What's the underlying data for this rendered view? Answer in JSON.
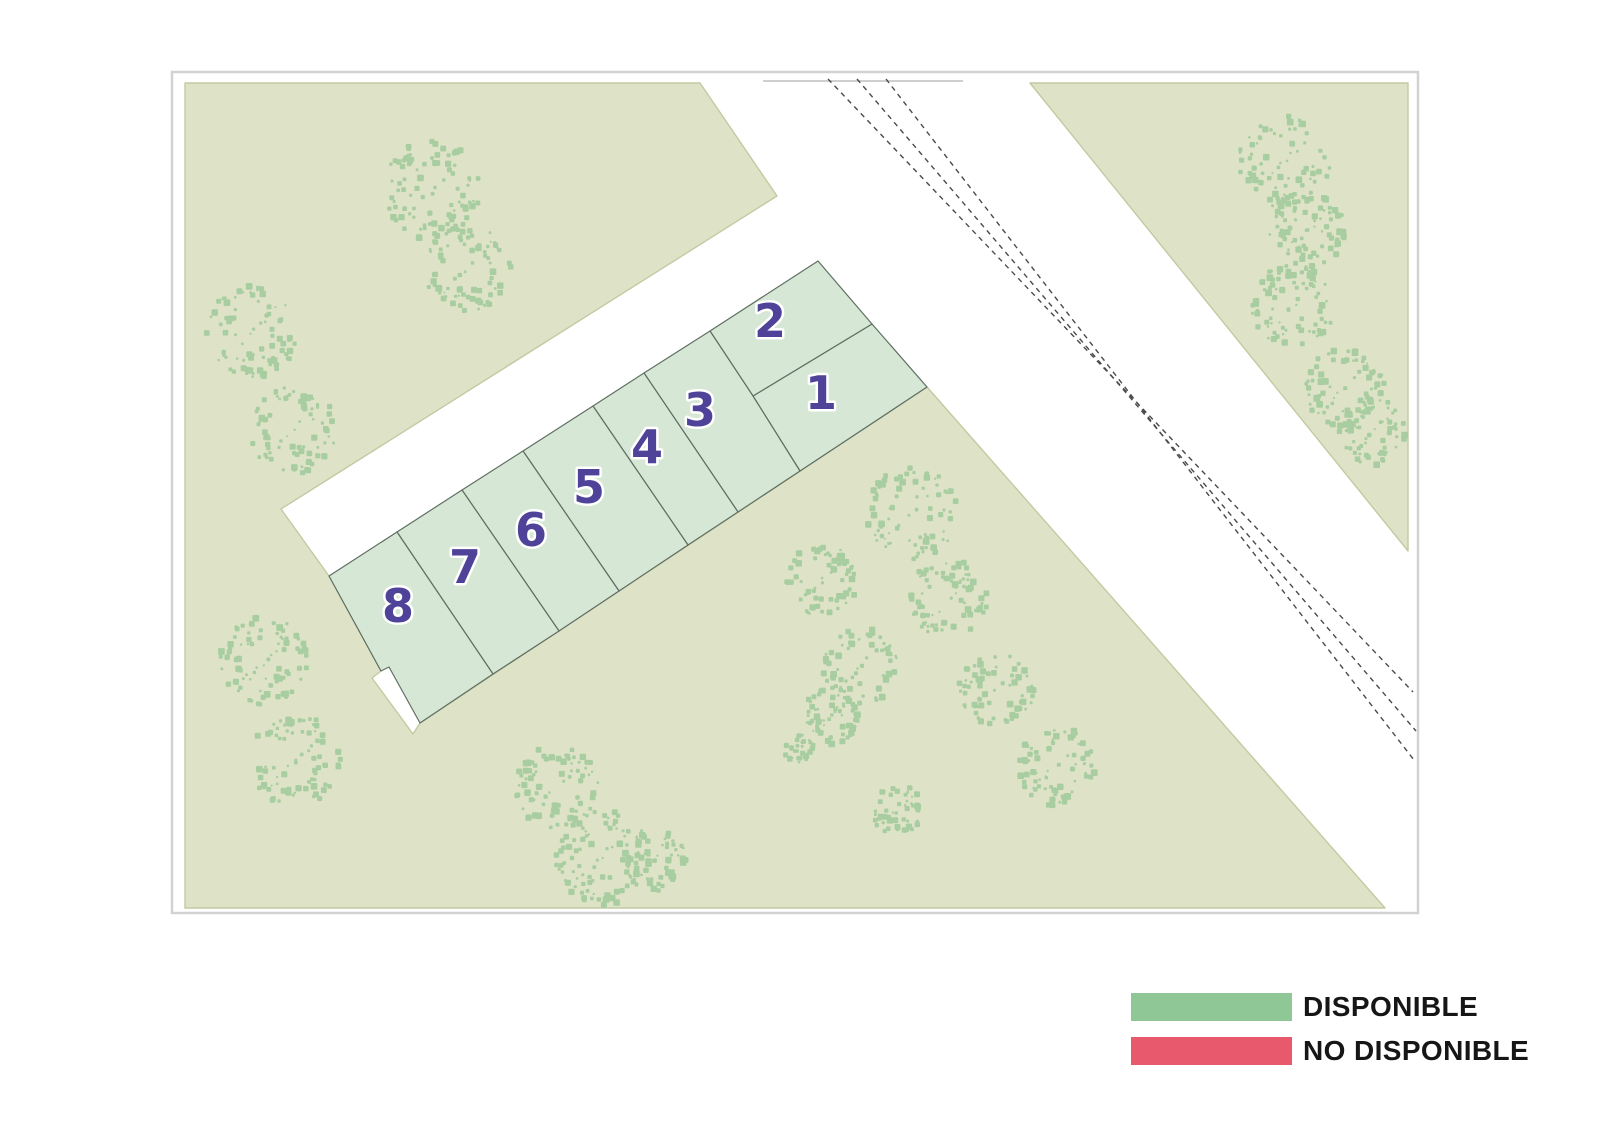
{
  "legend": {
    "items": [
      {
        "label": "DISPONIBLE",
        "color": "#90c796",
        "status": "disponible"
      },
      {
        "label": "NO DISPONIBLE",
        "color": "#e9596e",
        "status": "no-disponible"
      }
    ]
  },
  "map": {
    "width": 1600,
    "height": 1132,
    "frame": {
      "x": 172,
      "y": 72,
      "width": 1246,
      "height": 841,
      "stroke": "#d2d2d2"
    },
    "colors": {
      "background": "#ffffff",
      "parcel_fill": "#dee3c8",
      "parcel_stroke": "#c2caa2",
      "plot_fill": "#d6e8d5",
      "plot_stroke": "#5f6e62",
      "tree": "#a8cda0",
      "road_line": "#4a4a48",
      "road_edge_line": "#cfcfcf",
      "number_fill": "#4f4399",
      "number_halo": "#ffffff"
    },
    "parcels": [
      {
        "name": "parcel-west",
        "points": "185,83 700,83 777,196 281,509 329,576 381,671 372,678 413,734 420,723 927,387 1385,908 185,908"
      },
      {
        "name": "parcel-northeast",
        "points": "1030,83 1408,83 1408,551"
      }
    ],
    "road_edge_line": {
      "x1": 763,
      "y1": 81,
      "x2": 963,
      "y2": 81
    },
    "road_markings": [
      {
        "x1": 828,
        "y1": 79,
        "x2": 1413,
        "y2": 692
      },
      {
        "x1": 857,
        "y1": 79,
        "x2": 1416,
        "y2": 731
      },
      {
        "x1": 886,
        "y1": 79,
        "x2": 1414,
        "y2": 760
      }
    ],
    "plots": [
      {
        "number": "1",
        "status": "disponible",
        "points": "753,396 872,324 927,387 800,471",
        "label": {
          "x": 821,
          "y": 393
        }
      },
      {
        "number": "2",
        "status": "disponible",
        "points": "710,331 818,261 872,324 753,396",
        "label": {
          "x": 770,
          "y": 321
        }
      },
      {
        "number": "3",
        "status": "disponible",
        "points": "644,373 710,331 753,396 800,471 738,512",
        "label": {
          "x": 700,
          "y": 410
        }
      },
      {
        "number": "4",
        "status": "disponible",
        "points": "593,406 644,373 738,512 688,545",
        "label": {
          "x": 647,
          "y": 447
        }
      },
      {
        "number": "5",
        "status": "disponible",
        "points": "523,451 593,406 688,545 619,591",
        "label": {
          "x": 589,
          "y": 487
        }
      },
      {
        "number": "6",
        "status": "disponible",
        "points": "462,490 523,451 619,591 559,631",
        "label": {
          "x": 531,
          "y": 530
        }
      },
      {
        "number": "7",
        "status": "disponible",
        "points": "397,532 462,490 559,631 493,674",
        "label": {
          "x": 465,
          "y": 567
        }
      },
      {
        "number": "8",
        "status": "disponible",
        "points": "329,576 397,532 493,674 420,723 389,667 381,671",
        "label": {
          "x": 398,
          "y": 606
        }
      }
    ],
    "trees": [
      {
        "x": 433,
        "y": 190,
        "r": 50
      },
      {
        "x": 468,
        "y": 267,
        "r": 44
      },
      {
        "x": 252,
        "y": 332,
        "r": 46
      },
      {
        "x": 293,
        "y": 430,
        "r": 44
      },
      {
        "x": 1284,
        "y": 162,
        "r": 46
      },
      {
        "x": 1307,
        "y": 230,
        "r": 38
      },
      {
        "x": 1293,
        "y": 305,
        "r": 42
      },
      {
        "x": 1345,
        "y": 388,
        "r": 40
      },
      {
        "x": 1372,
        "y": 432,
        "r": 34
      },
      {
        "x": 912,
        "y": 513,
        "r": 46
      },
      {
        "x": 948,
        "y": 599,
        "r": 40
      },
      {
        "x": 822,
        "y": 580,
        "r": 36
      },
      {
        "x": 861,
        "y": 666,
        "r": 38
      },
      {
        "x": 829,
        "y": 716,
        "r": 29
      },
      {
        "x": 799,
        "y": 749,
        "r": 15
      },
      {
        "x": 997,
        "y": 687,
        "r": 38
      },
      {
        "x": 1056,
        "y": 766,
        "r": 40
      },
      {
        "x": 897,
        "y": 810,
        "r": 26
      },
      {
        "x": 264,
        "y": 661,
        "r": 44
      },
      {
        "x": 296,
        "y": 761,
        "r": 46
      },
      {
        "x": 557,
        "y": 787,
        "r": 42
      },
      {
        "x": 601,
        "y": 858,
        "r": 48
      },
      {
        "x": 654,
        "y": 860,
        "r": 32
      }
    ]
  }
}
